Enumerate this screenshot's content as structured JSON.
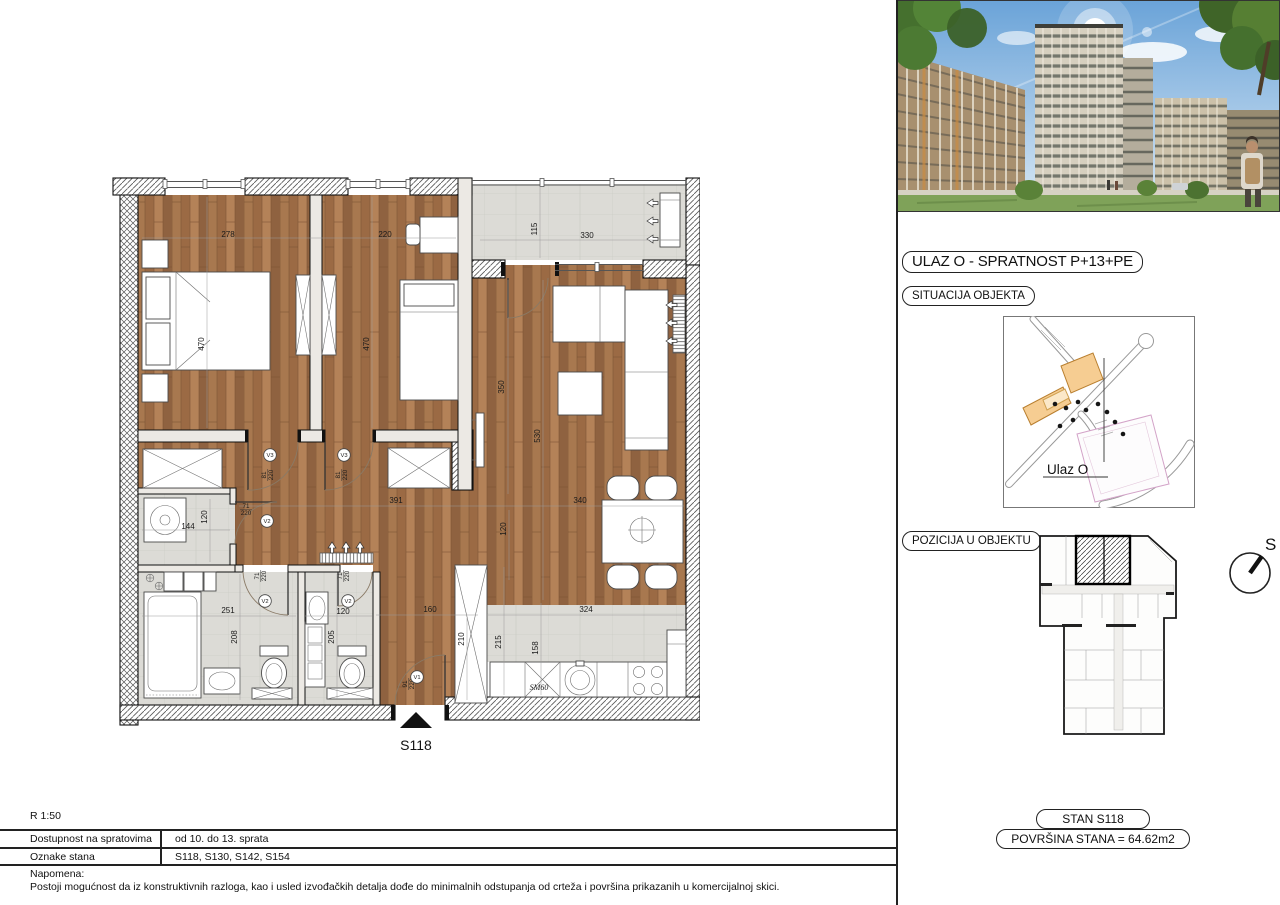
{
  "plan": {
    "entrance_label": "S118",
    "dims": [
      {
        "t": "278",
        "x": 128,
        "y": 65
      },
      {
        "t": "220",
        "x": 285,
        "y": 65
      },
      {
        "t": "115",
        "x": 437,
        "y": 57,
        "r": 1
      },
      {
        "t": "330",
        "x": 487,
        "y": 66
      },
      {
        "t": "470",
        "x": 104,
        "y": 172,
        "r": 1
      },
      {
        "t": "470",
        "x": 269,
        "y": 172,
        "r": 1
      },
      {
        "t": "350",
        "x": 404,
        "y": 215,
        "r": 1
      },
      {
        "t": "530",
        "x": 440,
        "y": 264,
        "r": 1
      },
      {
        "t": "391",
        "x": 296,
        "y": 331
      },
      {
        "t": "340",
        "x": 480,
        "y": 331
      },
      {
        "t": "120",
        "x": 406,
        "y": 357,
        "r": 1
      },
      {
        "t": "144",
        "x": 88,
        "y": 357
      },
      {
        "t": "120",
        "x": 107,
        "y": 345,
        "r": 1
      },
      {
        "t": "251",
        "x": 128,
        "y": 441
      },
      {
        "t": "208",
        "x": 137,
        "y": 465,
        "r": 1
      },
      {
        "t": "120",
        "x": 243,
        "y": 442
      },
      {
        "t": "205",
        "x": 234,
        "y": 465,
        "r": 1
      },
      {
        "t": "160",
        "x": 330,
        "y": 440
      },
      {
        "t": "210",
        "x": 364,
        "y": 467,
        "r": 1
      },
      {
        "t": "215",
        "x": 401,
        "y": 470,
        "r": 1
      },
      {
        "t": "158",
        "x": 438,
        "y": 476,
        "r": 1
      },
      {
        "t": "324",
        "x": 486,
        "y": 440
      },
      {
        "t": "SM60",
        "x": 439,
        "y": 518,
        "i": 1
      }
    ],
    "doors": [
      {
        "v": "V3",
        "cx": 170,
        "cy": 283,
        "num": "81",
        "den": "220",
        "fx": 166,
        "fy": 303,
        "r": 1
      },
      {
        "v": "V3",
        "cx": 244,
        "cy": 283,
        "num": "81",
        "den": "220",
        "fx": 240,
        "fy": 303,
        "r": 1
      },
      {
        "v": "V2",
        "cx": 167,
        "cy": 349,
        "num": "71",
        "den": "220",
        "fx": 146,
        "fy": 336,
        "r": 0
      },
      {
        "v": "V2",
        "cx": 165,
        "cy": 429,
        "num": "71",
        "den": "220",
        "fx": 159,
        "fy": 404,
        "r": 1
      },
      {
        "v": "V2",
        "cx": 248,
        "cy": 429,
        "num": "71",
        "den": "220",
        "fx": 242,
        "fy": 404,
        "r": 1
      },
      {
        "v": "V1",
        "cx": 317,
        "cy": 505,
        "num": "91",
        "den": "220",
        "fx": 307,
        "fy": 512,
        "r": 1
      }
    ]
  },
  "right_panel": {
    "title": "ULAZ O - SPRATNOST P+13+PE",
    "situacija": "SITUACIJA OBJEKTA",
    "ulaz": "Ulaz O",
    "pozicija": "POZICIJA U OBJEKTU",
    "compass": "S",
    "stan": "STAN S118",
    "povrsina": "POVRŠINA STANA = 64.62m2"
  },
  "footer": {
    "scale": "R 1:50",
    "rows": [
      {
        "label": "Dostupnost na spratovima",
        "value": "od 10. do 13. sprata"
      },
      {
        "label": "Oznake stana",
        "value": "S118, S130, S142, S154"
      }
    ],
    "note_title": "Napomena:",
    "note": "Postoji mogućnost da iz konstruktivnih razloga, kao i usled izvođačkih detalja dođe do minimalnih odstupanja od crteža i površina prikazanih u komercijalnoj skici."
  }
}
